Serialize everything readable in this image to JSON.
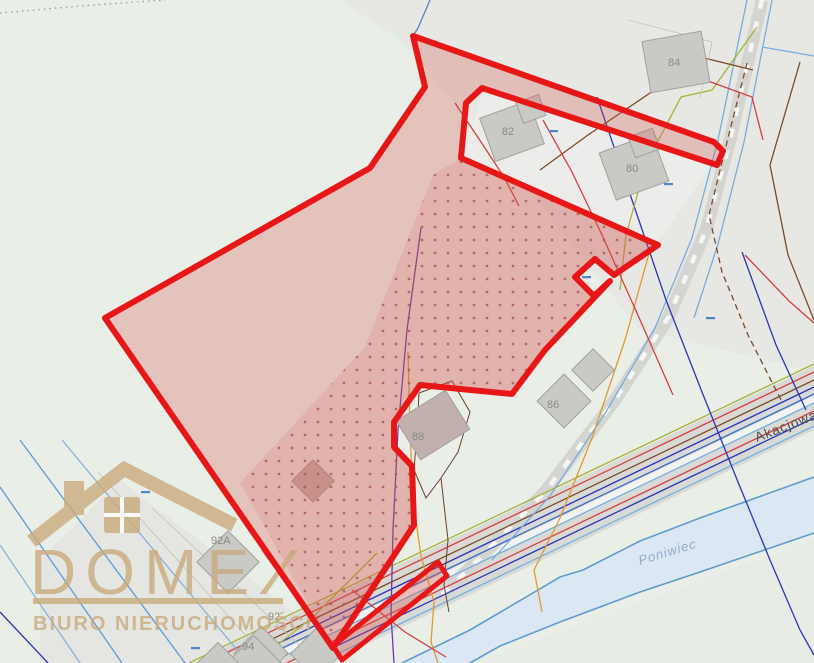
{
  "map": {
    "type": "cadastral-parcel-map",
    "canvas": {
      "width": 814,
      "height": 663
    },
    "streets": [
      {
        "label": "Akacjowa"
      }
    ],
    "waterways": [
      {
        "label": "Poniwiec"
      }
    ],
    "buildings": [
      {
        "label": "84"
      },
      {
        "label": "82"
      },
      {
        "label": "80"
      },
      {
        "label": "86"
      },
      {
        "label": "88"
      },
      {
        "label": "92A"
      },
      {
        "label": "92"
      },
      {
        "label": "94"
      }
    ],
    "highlight": {
      "description": "offered parcel outlined in thick red with translucent red fill and red dot-grid hatch; excluded notches around buildings 82/80, 88 and a small square on the east edge; narrow annex strip along the road at bottom",
      "stroke_color": "#e81717",
      "fill_color": "rgba(216,86,80,0.28)",
      "dot_color": "#a85858"
    },
    "colors": {
      "background": "#e9eee6",
      "background_gray": "#e7e7e3",
      "road": "#d9d9d6",
      "stream_fill": "#dbe8f4",
      "stream_line": "#5f9bd0",
      "building_fill": "#c9c9c6",
      "utility_blue": "#3a6cc8",
      "utility_lightblue": "#74b0e0",
      "utility_navy": "#2a34bc",
      "utility_red": "#d84040",
      "utility_brown": "#7c4b28",
      "utility_olive": "#a9b23a",
      "utility_orange": "#e09a30",
      "utility_purple": "#6a3ab0"
    }
  },
  "watermark": {
    "brand": "DOMEX",
    "tagline": "BIURO NIERUCHOMOŚCI",
    "color": "#c9ab7e",
    "icon": "house-icon"
  }
}
